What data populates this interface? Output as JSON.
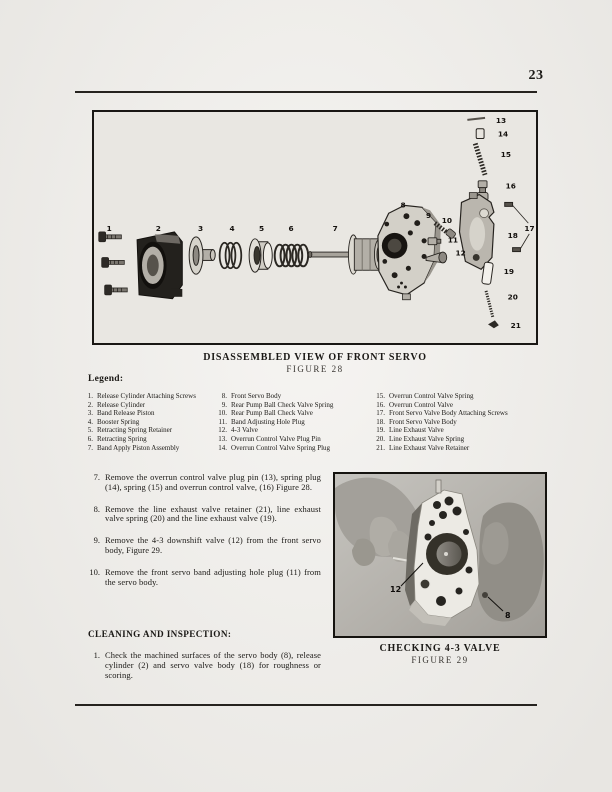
{
  "page": {
    "number": "23"
  },
  "figure28": {
    "title": "DISASSEMBLED VIEW OF FRONT SERVO",
    "figure_label": "FIGURE 28",
    "labels": [
      {
        "n": "1",
        "x": 11,
        "y": 121
      },
      {
        "n": "2",
        "x": 61,
        "y": 121
      },
      {
        "n": "3",
        "x": 104,
        "y": 121
      },
      {
        "n": "4",
        "x": 136,
        "y": 121
      },
      {
        "n": "5",
        "x": 166,
        "y": 121
      },
      {
        "n": "6",
        "x": 196,
        "y": 121
      },
      {
        "n": "7",
        "x": 241,
        "y": 121
      },
      {
        "n": "8",
        "x": 310,
        "y": 97
      },
      {
        "n": "9",
        "x": 336,
        "y": 108
      },
      {
        "n": "10",
        "x": 352,
        "y": 113
      },
      {
        "n": "11",
        "x": 358,
        "y": 133
      },
      {
        "n": "12",
        "x": 366,
        "y": 146
      },
      {
        "n": "13",
        "x": 407,
        "y": 11
      },
      {
        "n": "14",
        "x": 409,
        "y": 25
      },
      {
        "n": "15",
        "x": 412,
        "y": 46
      },
      {
        "n": "16",
        "x": 417,
        "y": 78
      },
      {
        "n": "17",
        "x": 436,
        "y": 121
      },
      {
        "n": "18",
        "x": 419,
        "y": 128
      },
      {
        "n": "19",
        "x": 415,
        "y": 165
      },
      {
        "n": "20",
        "x": 419,
        "y": 191
      },
      {
        "n": "21",
        "x": 422,
        "y": 220
      }
    ]
  },
  "legend": {
    "heading": "Legend:",
    "columns": [
      [
        {
          "num": "1.",
          "text": "Release Cylinder Attaching Screws"
        },
        {
          "num": "2.",
          "text": "Release Cylinder"
        },
        {
          "num": "3.",
          "text": "Band Release Piston"
        },
        {
          "num": "4.",
          "text": "Booster Spring"
        },
        {
          "num": "5.",
          "text": "Retracting Spring Retainer"
        },
        {
          "num": "6.",
          "text": "Retracting Spring"
        },
        {
          "num": "7.",
          "text": "Band Apply Piston Assembly"
        }
      ],
      [
        {
          "num": "8.",
          "text": "Front Servo Body"
        },
        {
          "num": "9.",
          "text": "Rear Pump Ball Check Valve Spring"
        },
        {
          "num": "10.",
          "text": "Rear Pump Ball Check Valve"
        },
        {
          "num": "11.",
          "text": "Band Adjusting Hole Plug"
        },
        {
          "num": "12.",
          "text": "4-3 Valve"
        },
        {
          "num": "13.",
          "text": "Overrun Control Valve Plug Pin"
        },
        {
          "num": "14.",
          "text": "Overrun Control Valve Spring Plug"
        }
      ],
      [
        {
          "num": "15.",
          "text": "Overrun Control Valve Spring"
        },
        {
          "num": "16.",
          "text": "Overrun Control Valve"
        },
        {
          "num": "17.",
          "text": "Front Servo Valve Body Attaching Screws"
        },
        {
          "num": "18.",
          "text": "Front Servo Valve Body"
        },
        {
          "num": "19.",
          "text": "Line Exhaust Valve"
        },
        {
          "num": "20.",
          "text": "Line Exhaust Valve Spring"
        },
        {
          "num": "21.",
          "text": "Line Exhaust Valve Retainer"
        }
      ]
    ]
  },
  "steps": [
    {
      "num": "7.",
      "text": "Remove the overrun control valve plug pin (13), spring plug (14), spring (15) and overrun control valve, (16) Figure 28."
    },
    {
      "num": "8.",
      "text": "Remove the line exhaust valve retainer (21), line exhaust valve spring (20) and the line exhaust valve (19)."
    },
    {
      "num": "9.",
      "text": "Remove the 4-3 downshift valve (12) from the front servo body, Figure 29."
    },
    {
      "num": "10.",
      "text": "Remove the front servo band adjusting hole plug (11) from the servo body."
    }
  ],
  "cleaning": {
    "heading": "CLEANING AND INSPECTION:",
    "steps": [
      {
        "num": "1.",
        "text": "Check the machined surfaces of the servo body (8), release cylinder (2) and servo valve body (18) for roughness or scoring."
      }
    ]
  },
  "figure29": {
    "title": "CHECKING 4-3 VALVE",
    "figure_label": "FIGURE 29",
    "labels": [
      {
        "n": "12",
        "x": 55,
        "y": 118
      },
      {
        "n": "8",
        "x": 170,
        "y": 144
      }
    ]
  }
}
